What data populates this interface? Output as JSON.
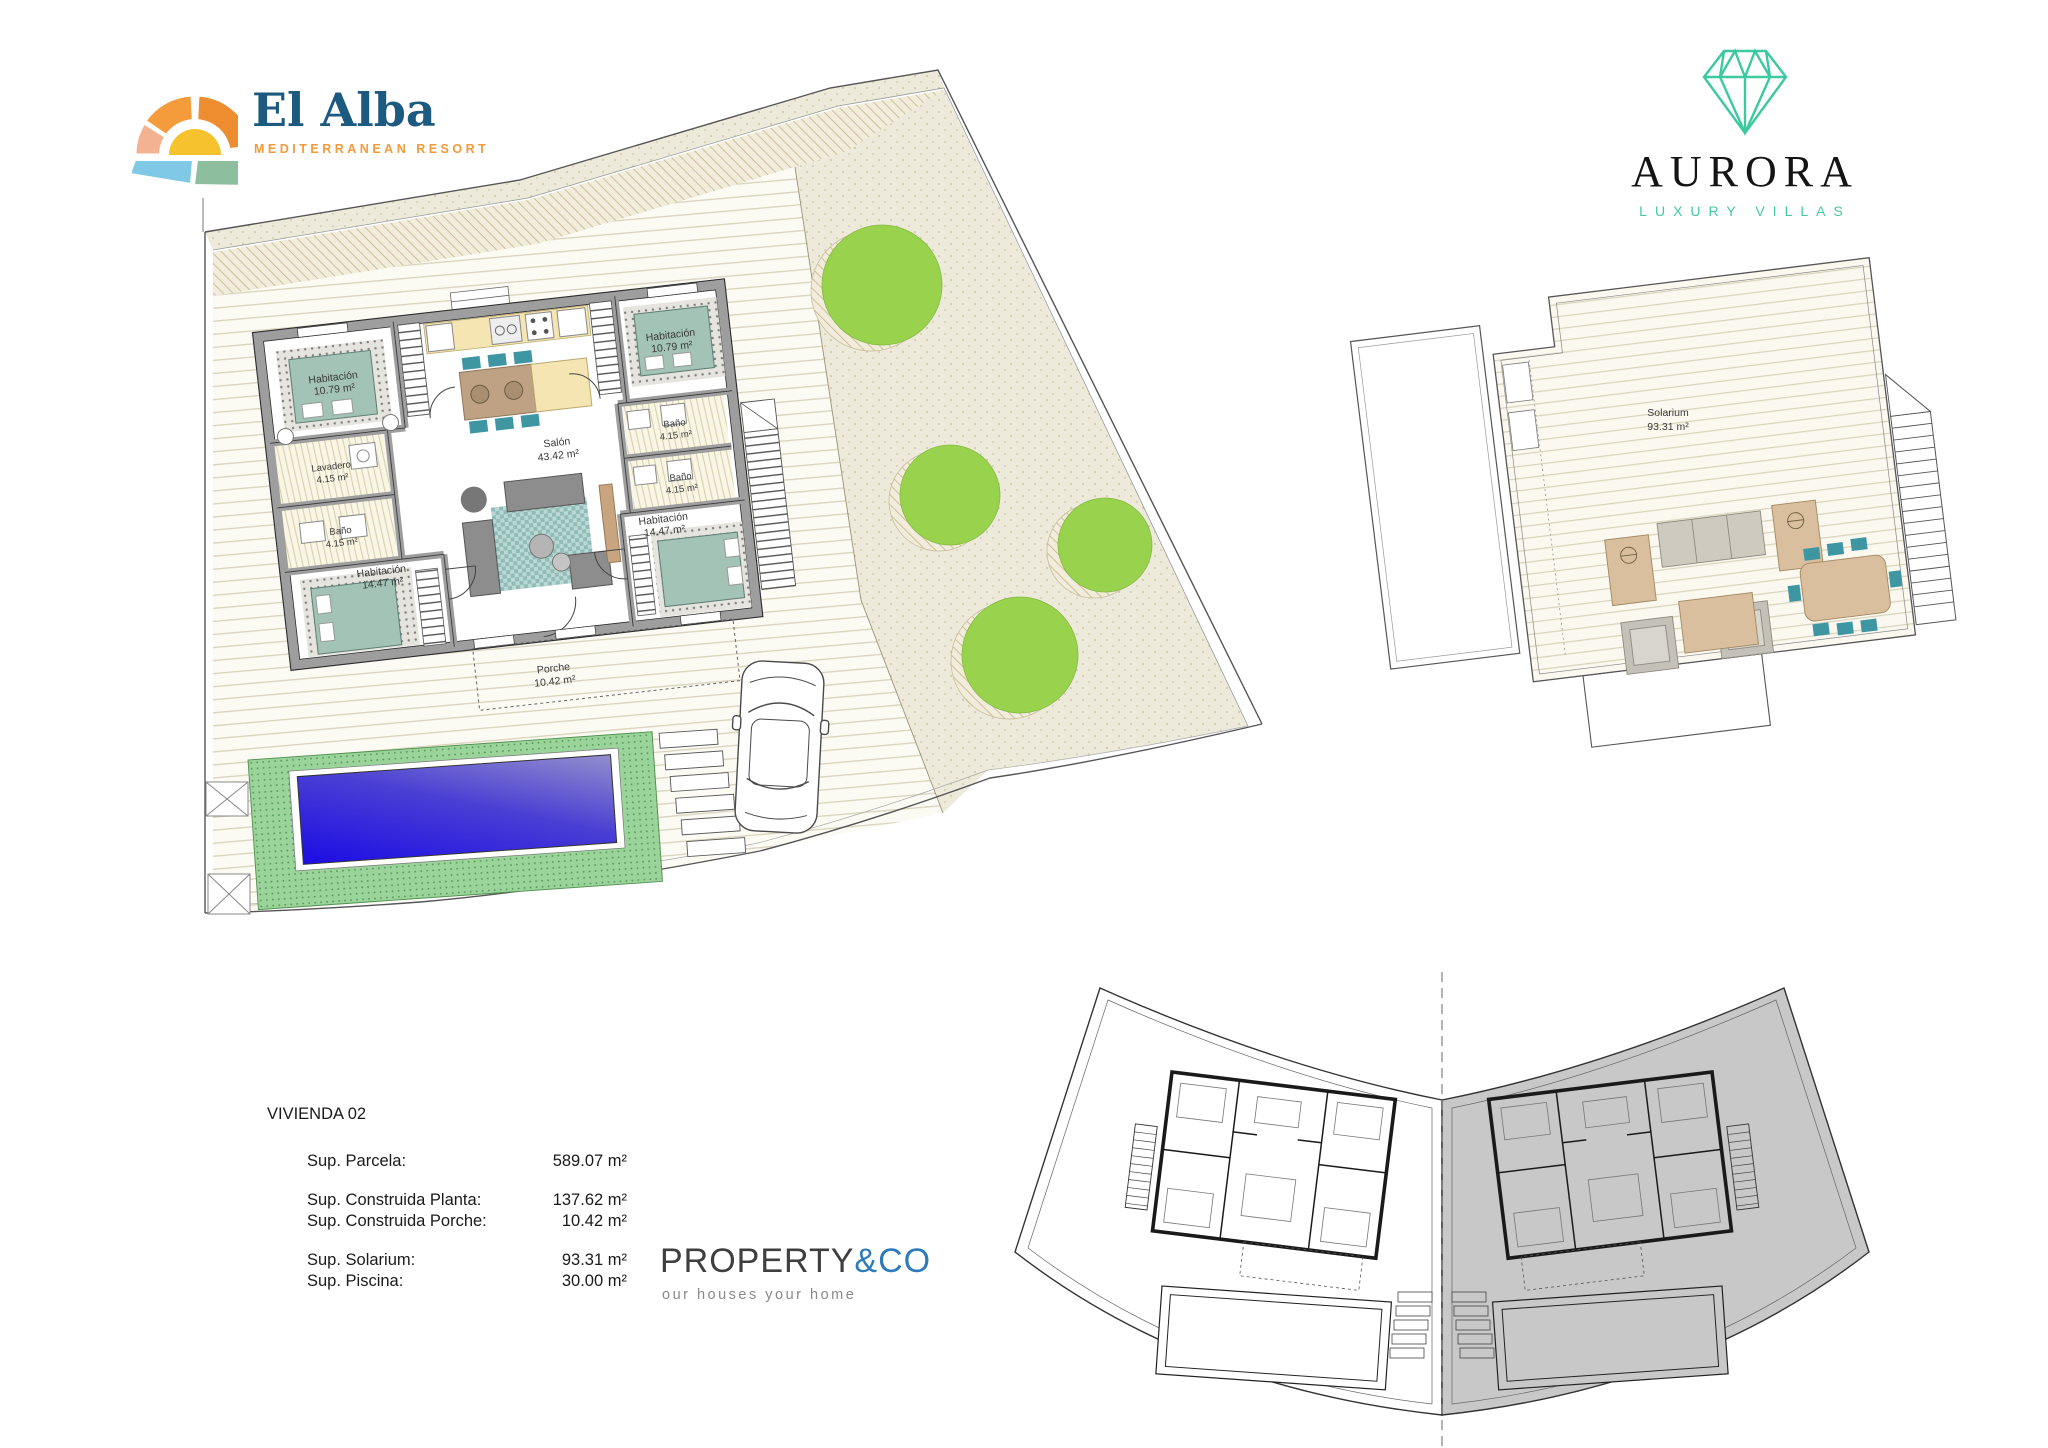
{
  "branding": {
    "el_alba": {
      "name": "El Alba",
      "tagline": "MEDITERRANEAN RESORT"
    },
    "aurora": {
      "name": "AURORA",
      "tagline": "LUXURY VILLAS"
    },
    "property_co": {
      "name_primary": "PROPERTY",
      "name_accent": "&CO",
      "tagline": "our houses your home"
    }
  },
  "floorplan": {
    "rooms": [
      {
        "name": "Habitación",
        "area": "10.79 m²"
      },
      {
        "name": "Habitación",
        "area": "10.79 m²"
      },
      {
        "name": "Lavadero",
        "area": "4.15 m²"
      },
      {
        "name": "Baño",
        "area": "4.15 m²"
      },
      {
        "name": "Baño",
        "area": "4.15 m²"
      },
      {
        "name": "Baño",
        "area": "4.15 m²"
      },
      {
        "name": "Salón",
        "area": "43.42 m²"
      },
      {
        "name": "Habitación",
        "area": "14.47 m²"
      },
      {
        "name": "Habitación",
        "area": "14.47 m²"
      },
      {
        "name": "Porche",
        "area": "10.42 m²"
      }
    ],
    "solarium": {
      "name": "Solarium",
      "area": "93.31 m²"
    }
  },
  "info": {
    "title": "VIVIENDA 02",
    "rows": [
      {
        "label": "Sup. Parcela:",
        "value": "589.07 m²"
      },
      {
        "label": "Sup. Construida Planta:",
        "value": "137.62 m²"
      },
      {
        "label": "Sup. Construida Porche:",
        "value": "10.42 m²"
      },
      {
        "label": "Sup. Solarium:",
        "value": "93.31 m²"
      },
      {
        "label": "Sup. Piscina:",
        "value": "30.00 m²"
      }
    ]
  },
  "colors": {
    "brand_blue": "#1c5a80",
    "brand_orange": "#f39b3c",
    "aurora_teal": "#45c7a4",
    "propco_blue": "#2e7bbc",
    "pool_blue": "#2213cf",
    "lawn_green": "#9bd49b",
    "tree_green": "#99d34e",
    "wall_gray": "#9e9e9e"
  }
}
